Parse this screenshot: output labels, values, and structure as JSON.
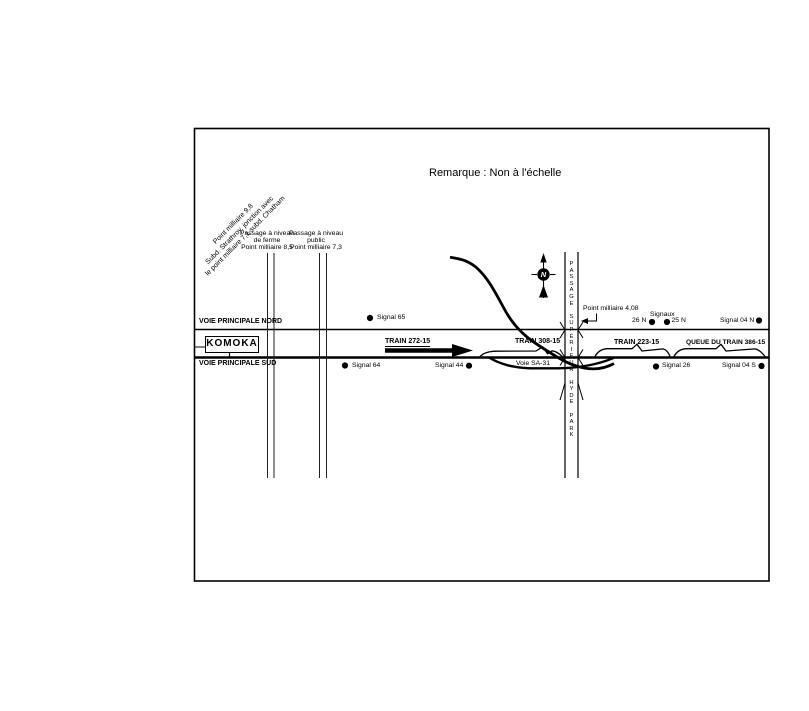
{
  "figure": {
    "note": "Remarque : Non à l'échelle",
    "junction": {
      "line1": "Point milliaire 9,8",
      "line2": "Subd. Strathroy, jonction avec",
      "line3": "le point milliaire 7,1 subd. Chatham"
    },
    "farm_crossing": {
      "line1": "Passage à niveau",
      "line2": "de ferme",
      "line3": "Point milliaire 8,5"
    },
    "public_crossing": {
      "line1": "Passage à niveau",
      "line2": "public",
      "line3": "Point milliaire 7,3"
    },
    "north_track_label": "VOIE PRINCIPALE NORD",
    "south_track_label": "VOIE PRINCIPALE SUD",
    "station": "KOMOKA",
    "overpass": "PASSAGE SUPÉRIEUR HYDE PARK",
    "mile_4_08": "Point milliaire 4,08",
    "signals_group": "Signaux",
    "compass": "N",
    "signals": {
      "signal_65": "Signal 65",
      "signal_64": "Signal 64",
      "signal_44": "Signal 44",
      "signal_26n": "26 N",
      "signal_25n": "25 N",
      "signal_04n": "Signal 04 N",
      "signal_26": "Signal 26",
      "signal_04s": "Signal 04 S"
    },
    "trains": {
      "train_272": "TRAIN 272-15",
      "train_308": "TRAIN 308-15",
      "train_223": "TRAIN 223-15",
      "train_386_tail": "QUEUE DU TRAIN 386-15"
    },
    "siding": "Voie SA-31",
    "colors": {
      "ink": "#000000",
      "background": "#ffffff"
    }
  }
}
